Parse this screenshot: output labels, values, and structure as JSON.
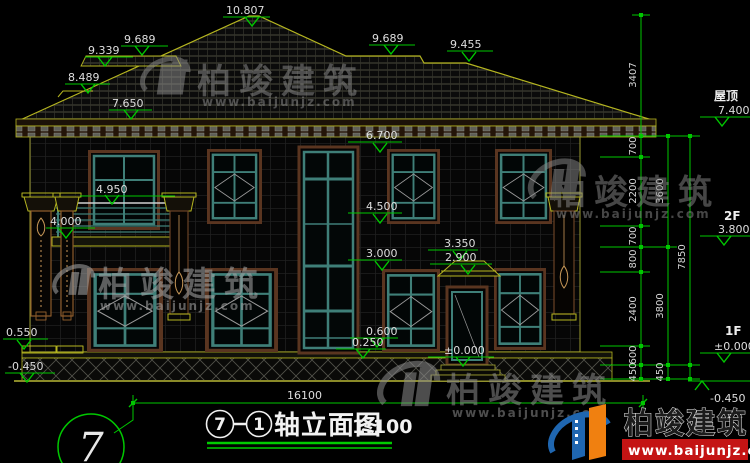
{
  "watermark": {
    "brand": "柏竣建筑",
    "url": "www.baijunjz.com"
  },
  "brand_badge": {
    "name": "柏竣建筑",
    "url": "www.baijunjz.com"
  },
  "levels": {
    "ridge": "10.807",
    "roof_left_upper": "9.689",
    "roof_left_band": "9.339",
    "roof_left_step": "8.489",
    "eave_left": "7.650",
    "roof_right_upper": "9.689",
    "roof_right_step": "9.455",
    "f2_window_head": "6.700",
    "balcony_rail": "4.950",
    "f2_window_sill": "4.500",
    "balcony_floor": "4.000",
    "canopy_top": "3.350",
    "stair_landing": "3.000",
    "canopy_soffit": "2.900",
    "f1_window_sill": "0.600",
    "terrace_wall": "0.550",
    "stair_window_sill": "0.250",
    "entry": "±0.000",
    "ground": "-0.450"
  },
  "right_panel": {
    "roof_label": "屋顶",
    "roof_level": "7.400",
    "floor2_label": "2F",
    "floor2_level": "3.800",
    "floor1_label": "1F",
    "floor1_level": "±0.000",
    "ground_level": "-0.450",
    "chain_inner": [
      "3407",
      "700",
      "2200",
      "700",
      "800",
      "2400",
      "600",
      "450"
    ],
    "chain_mid": [
      "3600",
      "3800",
      "450"
    ],
    "chain_total": "7850"
  },
  "bottom": {
    "overall_width": "16100",
    "axis_bubble": "7",
    "title_axis_start": "7",
    "title_axis_end": "1",
    "title_name": "轴立面图",
    "title_scale": "1:100"
  }
}
